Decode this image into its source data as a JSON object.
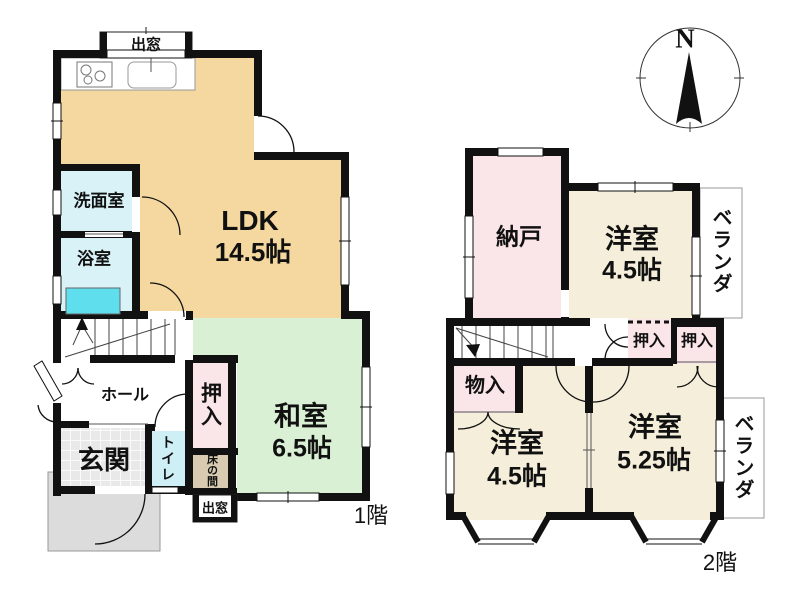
{
  "colors": {
    "wall": "#111111",
    "ldk": "#F4D8A0",
    "washitsu": "#D9F0D4",
    "water": "#D8F2F8",
    "toilet": "#CDEFF5",
    "bathtub": "#5FDEEE",
    "closet": "#FAE5E8",
    "tokonoma": "#D8CBB2",
    "western": "#F4EEDA",
    "genkan": "#E9E9E9",
    "porch": "#DCDCDC"
  },
  "compass": {
    "north_label": "N"
  },
  "floor1": {
    "floor_label": "1階",
    "bay_window_top": "出窓",
    "ldk_name": "LDK",
    "ldk_size": "14.5帖",
    "washroom": "洗面室",
    "bathroom": "浴室",
    "hall": "ホール",
    "entrance": "玄関",
    "toilet": "トイレ",
    "closet": "押入",
    "tokonoma": "床の間",
    "bay_window_bottom": "出窓",
    "washitsu_name": "和室",
    "washitsu_size": "6.5帖"
  },
  "floor2": {
    "floor_label": "2階",
    "storage_room": "納戸",
    "western_room_ne_name": "洋室",
    "western_room_ne_size": "4.5帖",
    "western_room_sw_name": "洋室",
    "western_room_sw_size": "4.5帖",
    "western_room_se_name": "洋室",
    "western_room_se_size": "5.25帖",
    "closet_left": "押入",
    "closet_right": "押入",
    "storage": "物入",
    "veranda_top": "ベランダ",
    "veranda_bottom": "ベランダ"
  }
}
